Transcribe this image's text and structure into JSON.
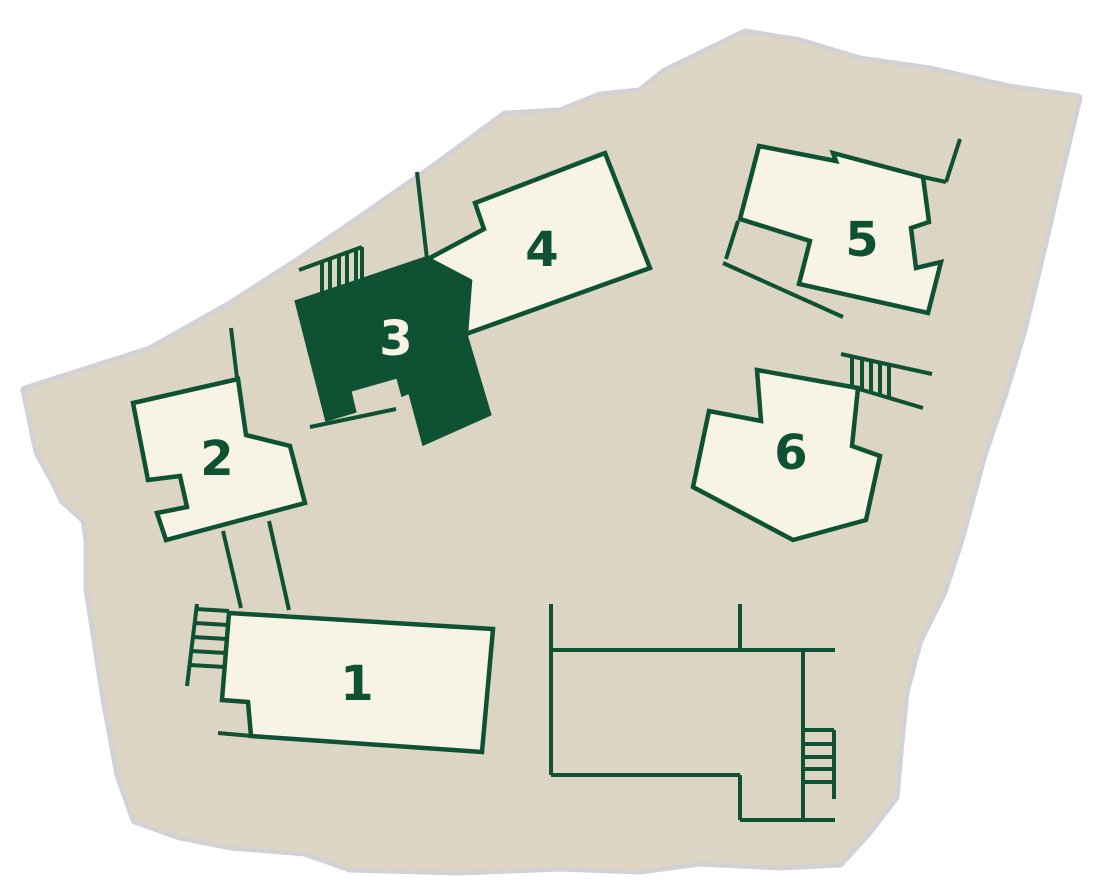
{
  "scene": {
    "width": 1110,
    "height": 896
  },
  "palette": {
    "page_background": "#FFFFFF",
    "ground": "#DCD5C3",
    "ground_edge": "#D2D1D6",
    "building_fill": "#F7F3E5",
    "outline": "#0E5233",
    "highlight_fill": "#0E5233",
    "label_dark": "#0E5233",
    "label_light": "#F7F3E5"
  },
  "ground": {
    "points": "25,390 38,452 55,483 63,500 85,520 88,540 88,589 105,699 119,775 135,820 180,836 231,846 305,852 350,868 460,871 560,867 640,870 700,862 780,866 840,863 868,832 895,797 900,742 905,692 919,640 943,592 960,540 983,455 1005,390 1023,330 1043,247 1060,173 1078,98 1009,88 930,70 860,60 800,42 745,33 700,55 665,72 640,92 600,96 560,112 505,115 440,163 370,212 300,260 230,305 150,350"
  },
  "buildings": [
    {
      "id": "building-1",
      "label": "1",
      "highlighted": false,
      "label_x": 357,
      "label_y": 684,
      "points": "229,613 493,629 482,752 251,736 248,702 222,700"
    },
    {
      "id": "building-2",
      "label": "2",
      "highlighted": false,
      "label_x": 217,
      "label_y": 459,
      "points": "133,403 238,379 246,435 290,446 305,503 166,540 157,513 187,507 180,476 148,480"
    },
    {
      "id": "building-3",
      "label": "3",
      "highlighted": true,
      "label_x": 396,
      "label_y": 339,
      "points": "297,302 428,258 471,281 466,337 489,414 424,443 410,391 403,394 398,376 349,390 354,411 327,419"
    },
    {
      "id": "building-4",
      "label": "4",
      "highlighted": false,
      "label_x": 542,
      "label_y": 250,
      "points": "475,203 605,153 650,268 466,334 470,281 428,259 484,229"
    },
    {
      "id": "building-5",
      "label": "5",
      "highlighted": false,
      "label_x": 862,
      "label_y": 240,
      "points": "759,146 836,161 833,153 923,177 929,222 911,228 916,268 941,262 928,313 799,284 810,241 740,219"
    },
    {
      "id": "building-6",
      "label": "6",
      "highlighted": false,
      "label_x": 791,
      "label_y": 453,
      "points": "757,370 858,388 852,446 880,456 866,520 793,540 693,487 709,411 761,421"
    }
  ],
  "walls": [
    {
      "name": "wall-above-building-4",
      "points": "417,172 427,259"
    },
    {
      "name": "wall-above-building-2",
      "points": "231,328 237,378"
    },
    {
      "name": "path-building-2-left",
      "points": "223,531 241,608"
    },
    {
      "name": "path-building-2-right",
      "points": "269,521 289,610"
    },
    {
      "name": "wall-building-1-bottom",
      "points": "218,733 252,736"
    },
    {
      "name": "wall-below-building-3",
      "points": "310,427 396,409"
    },
    {
      "name": "wall-building-5-stub",
      "points": "960,139 946,182"
    },
    {
      "name": "wall-building-5-top",
      "points": "923,177 946,182"
    },
    {
      "name": "wall-annex-left",
      "points": "738,221 726,259"
    },
    {
      "name": "wall-below-building-5",
      "points": "723,263 843,317"
    },
    {
      "name": "courtyard-left",
      "points": "551,604 551,775"
    },
    {
      "name": "courtyard-top",
      "points": "551,650 835,650"
    },
    {
      "name": "courtyard-inner",
      "points": "740,604 740,650"
    },
    {
      "name": "courtyard-right",
      "points": "803,650 803,820"
    },
    {
      "name": "courtyard-bottom-left",
      "points": "551,775 740,775"
    },
    {
      "name": "courtyard-step",
      "points": "740,775 740,820"
    },
    {
      "name": "courtyard-bottom",
      "points": "740,820 835,820"
    }
  ],
  "stairs": [
    {
      "name": "stairs-building-3",
      "lines": [
        [
          299,
          270,
          362,
          247
        ],
        [
          322,
          261,
          322,
          294
        ],
        [
          330,
          258,
          330,
          291
        ],
        [
          339,
          255,
          339,
          288
        ],
        [
          347,
          252,
          347,
          285
        ],
        [
          356,
          249,
          356,
          282
        ],
        [
          362,
          247,
          362,
          280
        ]
      ]
    },
    {
      "name": "stairs-building-1",
      "lines": [
        [
          197,
          604,
          187,
          686
        ],
        [
          196,
          609,
          229,
          611
        ],
        [
          195,
          623,
          228,
          625
        ],
        [
          193,
          637,
          227,
          639
        ],
        [
          191,
          651,
          226,
          653
        ],
        [
          190,
          665,
          225,
          667
        ]
      ]
    },
    {
      "name": "stairs-building-6",
      "lines": [
        [
          841,
          354,
          932,
          374
        ],
        [
          849,
          386,
          923,
          408
        ],
        [
          852,
          356,
          852,
          387
        ],
        [
          862,
          359,
          862,
          390
        ],
        [
          871,
          361,
          871,
          392
        ],
        [
          880,
          363,
          880,
          395
        ],
        [
          889,
          365,
          889,
          398
        ]
      ]
    },
    {
      "name": "stairs-courtyard",
      "lines": [
        [
          803,
          730,
          834,
          730
        ],
        [
          803,
          744,
          834,
          744
        ],
        [
          803,
          757,
          834,
          757
        ],
        [
          803,
          769,
          834,
          769
        ],
        [
          803,
          782,
          834,
          782
        ],
        [
          834,
          730,
          834,
          799
        ]
      ]
    }
  ]
}
